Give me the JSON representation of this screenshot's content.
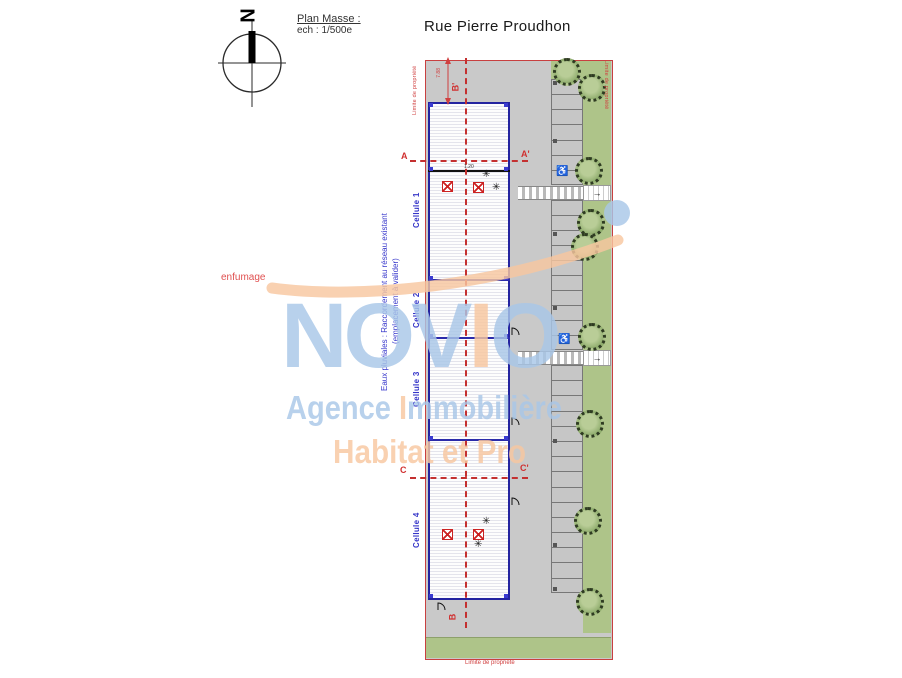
{
  "header": {
    "plan_title": "Plan Masse :",
    "plan_scale": "ech : 1/500e",
    "street_name": "Rue Pierre Proudhon",
    "compass_letter": "N"
  },
  "annotations": {
    "smoke_note": "enfumage",
    "rainwater_note_line1": "Eaux pluviales : Raccordement au réseau existant",
    "rainwater_note_line2": "(emplacement à valider)",
    "dim_top": "7.88",
    "dim_skylight": "1.20",
    "property_limit_left": "Limite de propriété",
    "property_limit_right": "Limite de propriété",
    "property_limit_bottom": "Limite de propriété",
    "sections": {
      "a": "A",
      "a_prime": "A'",
      "b": "B",
      "b_prime": "B'",
      "c": "C",
      "c_prime": "C'"
    }
  },
  "building": {
    "cells": [
      {
        "label": "Cellule 1",
        "cx": 418,
        "cy": 207
      },
      {
        "label": "Cellule 2",
        "cx": 418,
        "cy": 307
      },
      {
        "label": "Cellule 3",
        "cx": 418,
        "cy": 386
      },
      {
        "label": "Cellule 4",
        "cx": 418,
        "cy": 527
      }
    ],
    "dividers": [
      {
        "y": 170,
        "h": 2,
        "color": "#111111"
      },
      {
        "y": 279,
        "h": 2,
        "color": "#2a2aaa"
      },
      {
        "y": 337,
        "h": 2,
        "color": "#2a2aaa"
      },
      {
        "y": 439,
        "h": 2,
        "color": "#2a2aaa"
      }
    ],
    "roof_hatch_symbols": [
      {
        "x": 442,
        "y": 181
      },
      {
        "x": 473,
        "y": 182
      },
      {
        "x": 442,
        "y": 529
      },
      {
        "x": 473,
        "y": 529
      }
    ],
    "smoke_vent_symbols": [
      {
        "x": 482,
        "y": 170
      },
      {
        "x": 492,
        "y": 183
      },
      {
        "x": 482,
        "y": 517
      },
      {
        "x": 474,
        "y": 540
      }
    ],
    "doors": [
      {
        "x": 510,
        "y": 326
      },
      {
        "x": 510,
        "y": 416
      },
      {
        "x": 510,
        "y": 496
      },
      {
        "x": 436,
        "y": 601
      }
    ]
  },
  "site": {
    "trees": [
      {
        "x": 567,
        "y": 72
      },
      {
        "x": 592,
        "y": 88
      },
      {
        "x": 589,
        "y": 171
      },
      {
        "x": 591,
        "y": 223
      },
      {
        "x": 585,
        "y": 247
      },
      {
        "x": 592,
        "y": 337
      },
      {
        "x": 590,
        "y": 424
      },
      {
        "x": 588,
        "y": 521
      },
      {
        "x": 590,
        "y": 602
      }
    ],
    "parking": {
      "segments": [
        {
          "top": 79,
          "bottom": 185,
          "stalls": 7
        },
        {
          "top": 200,
          "bottom": 350,
          "stalls": 10
        },
        {
          "top": 365,
          "bottom": 593,
          "stalls": 15
        }
      ],
      "handicap_icon": "♿",
      "handicap": [
        {
          "x": 556,
          "y": 166
        },
        {
          "x": 558,
          "y": 334
        }
      ],
      "markers": [
        {
          "y": 79
        },
        {
          "y": 137
        },
        {
          "y": 230
        },
        {
          "y": 304
        },
        {
          "y": 437
        },
        {
          "y": 541
        },
        {
          "y": 585
        }
      ]
    },
    "crossings": [
      {
        "y": 186
      },
      {
        "y": 351
      }
    ],
    "crossing_arrow": "→"
  },
  "watermark": {
    "brand_letters": [
      {
        "ch": "N",
        "color": "#a9c7e8"
      },
      {
        "ch": "O",
        "color": "#a9c7e8"
      },
      {
        "ch": "V",
        "color": "#a9c7e8"
      },
      {
        "ch": "I",
        "color": "#f8c7a0"
      },
      {
        "ch": "O",
        "color": "#a9c7e8"
      }
    ],
    "line1_parts": [
      {
        "t": "Agence ",
        "color": "#a9c7e8"
      },
      {
        "t": "I",
        "color": "#f8c7a0"
      },
      {
        "t": "mmobilière",
        "color": "#a9c7e8"
      }
    ],
    "line2": "Habitat et Pro",
    "line2_color": "#f8c7a0",
    "accent_blue": "#a9c7e8",
    "accent_peach": "#f8c7a0"
  },
  "colors": {
    "site_gray": "#c9c9c9",
    "green": "#aec489",
    "building_outline": "#2424a0",
    "property_red": "#c84040",
    "label_blue": "#3535c8"
  }
}
